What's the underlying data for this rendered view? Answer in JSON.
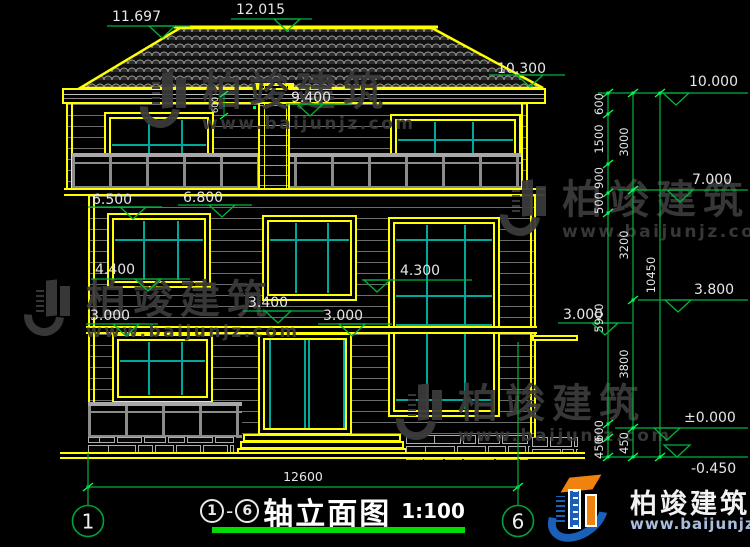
{
  "title": {
    "axis_start": "1",
    "axis_end": "6",
    "dash": "-",
    "name": "轴立面图",
    "scale": "1:100"
  },
  "brand": {
    "name": "柏竣建筑",
    "url": "www.baijunjz.com"
  },
  "colors": {
    "frame_yellow": "#ffff00",
    "dim_green": "#00b43c",
    "dim_bright": "#00ff55",
    "mullion_cyan": "#00a89b",
    "text_light": "#e6e6e6",
    "railing_gray": "#9c9c9c",
    "watermark_gray": "#3a3a3a",
    "logo_blue": "#1a5fb8",
    "logo_orange": "#f0820f",
    "underline_green": "#00dd00"
  },
  "annotations": {
    "levels": [
      {
        "label": "11.697",
        "tx": 112,
        "ty": 9,
        "x1": 107,
        "x2": 190,
        "ly": 26,
        "tri": 162
      },
      {
        "label": "12.015",
        "tx": 236,
        "ty": 2,
        "x1": 231,
        "x2": 312,
        "ly": 19,
        "tri": 287
      },
      {
        "label": "10.300",
        "tx": 497,
        "ty": 61,
        "x1": 489,
        "x2": 565,
        "ly": 75,
        "tri": 530
      },
      {
        "label": "9.400",
        "tx": 291,
        "ty": 90,
        "x1": 286,
        "x2": 352,
        "ly": 104,
        "tri": 310
      },
      {
        "label": "6.500",
        "tx": 92,
        "ty": 192,
        "x1": 88,
        "x2": 162,
        "ly": 207,
        "tri": 133
      },
      {
        "label": "6.800",
        "tx": 183,
        "ty": 190,
        "x1": 178,
        "x2": 252,
        "ly": 205,
        "tri": 222
      },
      {
        "label": "4.400",
        "tx": 95,
        "ty": 262,
        "x1": 91,
        "x2": 190,
        "ly": 279,
        "tri": 148
      },
      {
        "label": "4.300",
        "tx": 400,
        "ty": 263,
        "x1": 362,
        "x2": 472,
        "ly": 280,
        "tri": 377
      },
      {
        "label": "3.400",
        "tx": 248,
        "ty": 295,
        "x1": 243,
        "x2": 324,
        "ly": 311,
        "tri": 278
      },
      {
        "label": "3.000",
        "tx": 90,
        "ty": 308,
        "x1": 86,
        "x2": 158,
        "ly": 324,
        "tri": 126
      },
      {
        "label": "3.000",
        "tx": 323,
        "ty": 308,
        "x1": 318,
        "x2": 392,
        "ly": 324,
        "tri": 352
      },
      {
        "label": "3.000",
        "tx": 563,
        "ty": 307,
        "x1": 558,
        "x2": 632,
        "ly": 323,
        "tri": 605
      },
      {
        "label": "10.000",
        "tx": 689,
        "ty": 74,
        "x1": 598,
        "x2": 748,
        "ly": 93,
        "tri": 676
      },
      {
        "label": "7.000",
        "tx": 692,
        "ty": 172,
        "x1": 618,
        "x2": 748,
        "ly": 190,
        "tri": 680
      },
      {
        "label": "3.800",
        "tx": 694,
        "ty": 282,
        "x1": 638,
        "x2": 748,
        "ly": 300,
        "tri": 678
      },
      {
        "label": "±0.000",
        "tx": 684,
        "ty": 410,
        "x1": 615,
        "x2": 748,
        "ly": 428,
        "tri": 667
      },
      {
        "label": "-0.450",
        "tx": 691,
        "ty": 461,
        "x1": 600,
        "x2": 748,
        "ly": 457,
        "tri": 677,
        "flip": true
      }
    ],
    "chains": [
      {
        "x": 608,
        "ticks": [
          93,
          114,
          164,
          193,
          213,
          424,
          438,
          457
        ],
        "labels": [
          {
            "t": "600",
            "y": 104
          },
          {
            "t": "1500",
            "y": 139
          },
          {
            "t": "900",
            "y": 178
          },
          {
            "t": "500",
            "y": 203
          },
          {
            "t": "5900",
            "y": 318
          },
          {
            "t": "600",
            "y": 431
          },
          {
            "t": "450",
            "y": 448
          }
        ]
      },
      {
        "x": 633,
        "ticks": [
          93,
          190,
          300,
          428,
          457
        ],
        "labels": [
          {
            "t": "3000",
            "y": 142
          },
          {
            "t": "3200",
            "y": 245
          },
          {
            "t": "3800",
            "y": 364
          },
          {
            "t": "450",
            "y": 443
          }
        ]
      },
      {
        "x": 660,
        "ticks": [
          93,
          457
        ],
        "labels": [
          {
            "t": "10450",
            "y": 275
          }
        ]
      }
    ],
    "dim_bottom": {
      "label": "12600",
      "x1": 88,
      "x2": 518,
      "y": 487
    },
    "dim_small": {
      "label": "600",
      "x": 224,
      "y1": 94,
      "y2": 116
    },
    "axis_bubbles": [
      {
        "label": "1",
        "x": 88,
        "y": 521,
        "line_top": 453
      },
      {
        "label": "6",
        "x": 518,
        "y": 521,
        "line_top": 342
      }
    ]
  },
  "watermarks": [
    {
      "x": 140,
      "y": 72
    },
    {
      "x": 500,
      "y": 180
    },
    {
      "x": 24,
      "y": 280
    },
    {
      "x": 396,
      "y": 384
    }
  ]
}
